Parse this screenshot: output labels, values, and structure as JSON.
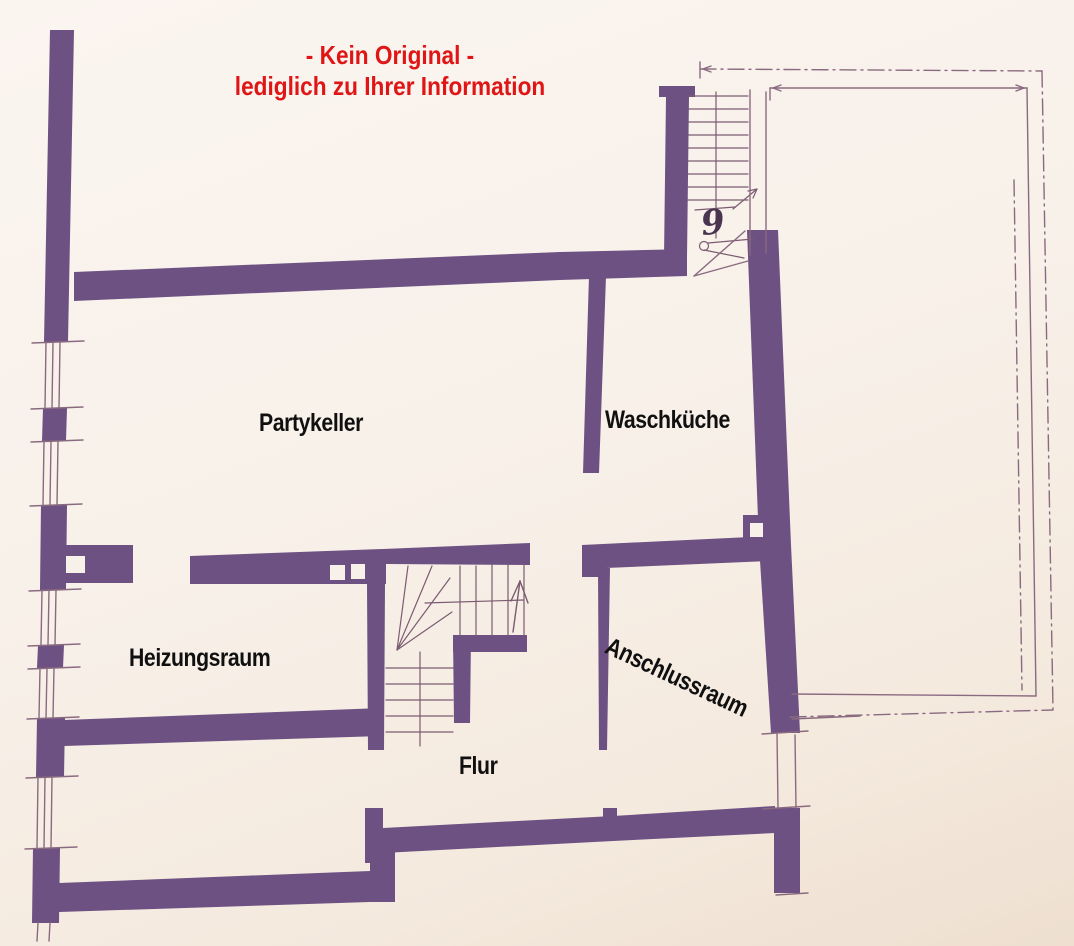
{
  "notice": {
    "line1": "- Kein Original -",
    "line2": "lediglich zu Ihrer Information"
  },
  "rooms": [
    {
      "id": "partykeller",
      "label": "Partykeller"
    },
    {
      "id": "waschkueche",
      "label": "Waschküche"
    },
    {
      "id": "heizungsraum",
      "label": "Heizungsraum"
    },
    {
      "id": "anschlussraum",
      "label": "Anschlussraum",
      "rotation_deg": 25
    },
    {
      "id": "flur",
      "label": "Flur"
    }
  ],
  "annotations": {
    "stair_count": "9"
  },
  "colors": {
    "wall": "#6c5182",
    "line": "#8a6a80",
    "hatch": "#7b5b71",
    "label": "#101010",
    "red": "#e01616",
    "paper": "#f8f1ea",
    "ink": "#4a3550"
  }
}
